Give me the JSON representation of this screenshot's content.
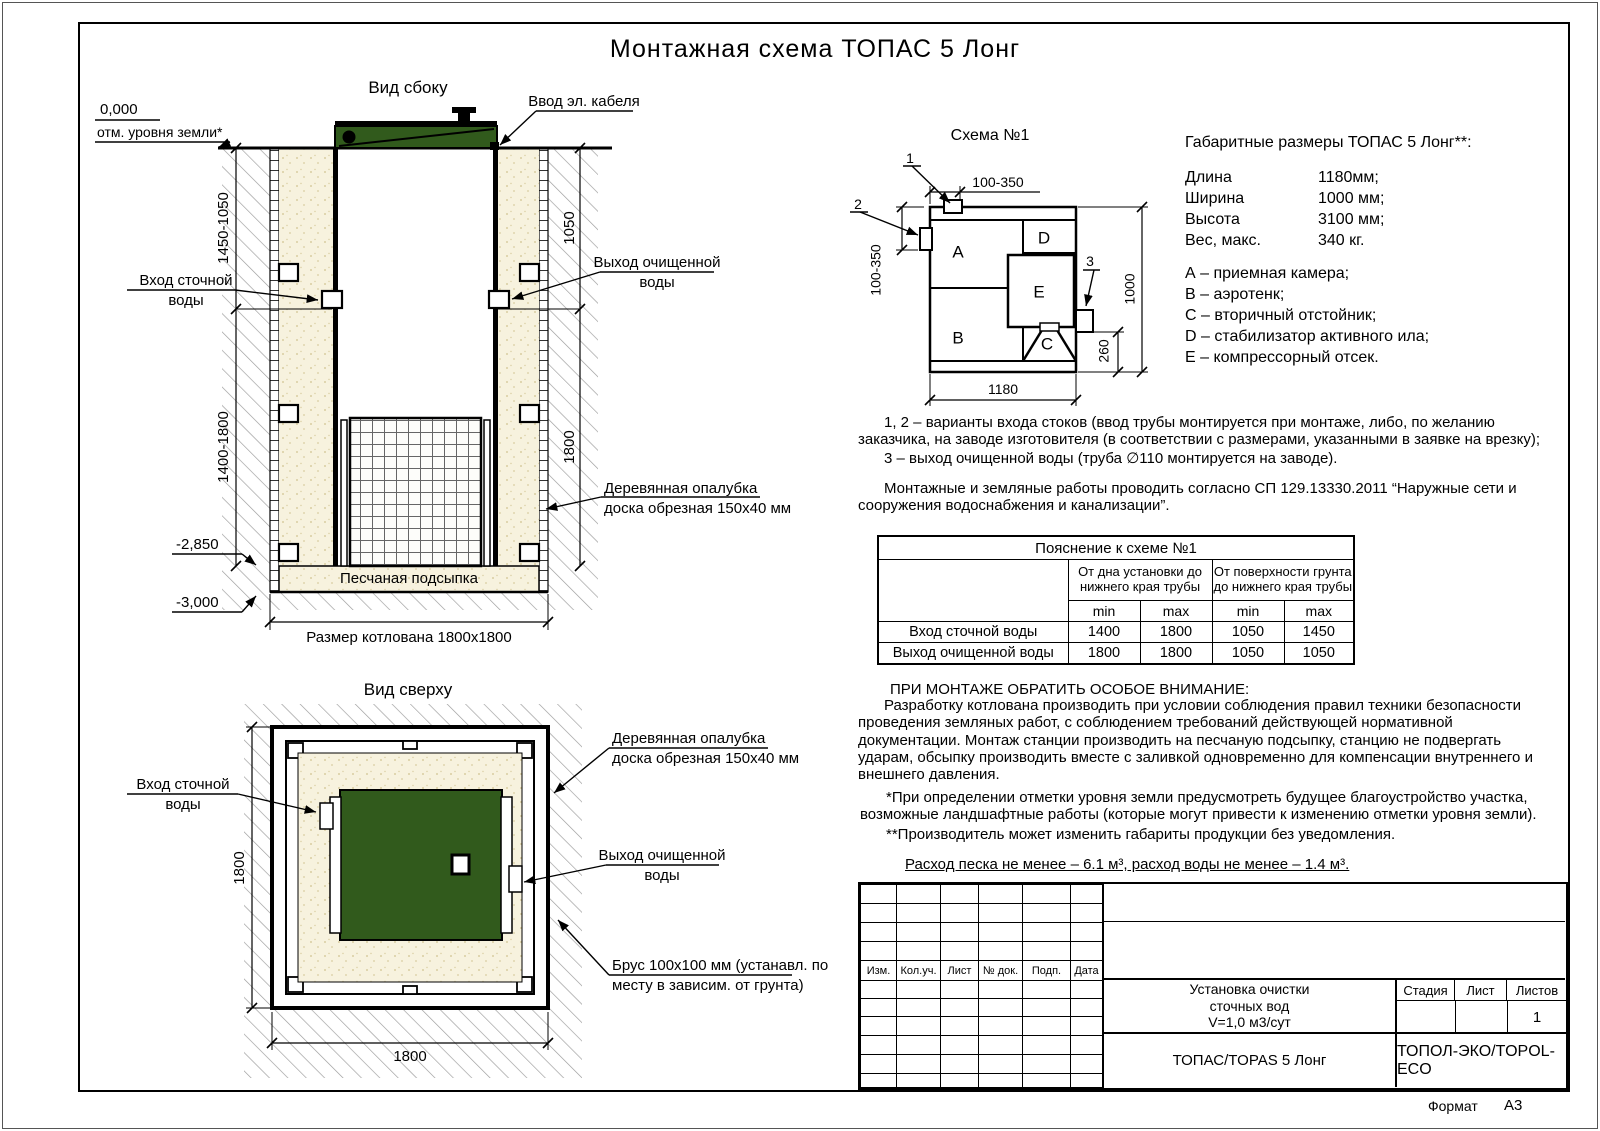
{
  "page": {
    "title": "Монтажная схема ТОПАС 5 Лонг",
    "format_label": "Формат",
    "format_value": "А3"
  },
  "side_view": {
    "title": "Вид сбоку",
    "labels": {
      "zero_level": "0,000",
      "ground_level": "отм. уровня земли*",
      "cable_entry": "Ввод эл. кабеля",
      "inlet_line1": "Вход сточной",
      "inlet_line2": "воды",
      "outlet_line1": "Выход очищенной",
      "outlet_line2": "воды",
      "formwork_line1": "Деревянная опалубка",
      "formwork_line2": "доска обрезная 150х40 мм",
      "sand_bed": "Песчаная подсыпка",
      "level_2850": "-2,850",
      "level_3000": "-3,000",
      "pit_size": "Размер котлована 1800х1800"
    },
    "dims": {
      "left_top": "1450-1050",
      "left_bottom": "1400-1800",
      "right_top": "1050",
      "right_bottom": "1800"
    }
  },
  "top_view": {
    "title": "Вид сверху",
    "labels": {
      "inlet_line1": "Вход сточной",
      "inlet_line2": "воды",
      "outlet_line1": "Выход очищенной",
      "outlet_line2": "воды",
      "formwork_line1": "Деревянная опалубка",
      "formwork_line2": "доска обрезная 150х40 мм",
      "beam_line1": "Брус 100х100 мм (устанавл. по",
      "beam_line2": "месту в зависим. от грунта)"
    },
    "dims": {
      "left": "1800",
      "bottom": "1800"
    }
  },
  "schema1": {
    "title": "Схема №1",
    "compartments": [
      "A",
      "B",
      "C",
      "D",
      "E"
    ],
    "callouts": [
      "1",
      "2",
      "3"
    ],
    "dims": {
      "top": "100-350",
      "left": "100-350",
      "right": "1000",
      "right2": "260",
      "bottom": "1180"
    }
  },
  "specs": {
    "heading": "Габаритные размеры ТОПАС 5 Лонг**:",
    "rows": [
      [
        "Длина",
        "1180мм;"
      ],
      [
        "Ширина",
        "1000 мм;"
      ],
      [
        "Высота",
        "3100 мм;"
      ],
      [
        "Вес, макс.",
        "340 кг."
      ]
    ],
    "legend": [
      "А – приемная камера;",
      "В – аэротенк;",
      "С – вторичный отстойник;",
      "D – стабилизатор активного ила;",
      "Е – компрессорный отсек."
    ]
  },
  "notes": {
    "variants": "1, 2 – варианты входа  стоков (ввод трубы монтируется при монтаже, либо, по желанию заказчика, на заводе изготовителя (в соответствии с размерами, указанными в заявке на врезку);",
    "outlet": "3 – выход очищенной воды (труба ∅110 монтируется на заводе).",
    "works": "Монтажные и земляные работы проводить согласно СП 129.13330.2011 “Наружные сети и сооружения водоснабжения и канализации”.",
    "attention_title": "ПРИ МОНТАЖЕ ОБРАТИТЬ ОСОБОЕ ВНИМАНИЕ:",
    "attention_body": "Разработку котлована производить при условии соблюдения правил техники безопасности проведения земляных работ, с соблюдением требований действующей нормативной документации. Монтаж станции производить на песчаную подсыпку, станцию не подвергать ударам, обсыпку производить вместе с заливкой одновременно для компенсации внутреннего и внешнего давления.",
    "footnote1": "*При определении отметки уровня земли предусмотреть будущее благоустройство участка, возможные ландшафтные работы (которые могут привести к изменению отметки уровня земли).",
    "footnote2": "**Производитель может изменить габариты продукции без уведомления.",
    "consumption": "Расход песка не менее – 6.1 м³, расход воды не менее – 1.4 м³."
  },
  "explain_table": {
    "title": "Пояснение к схеме №1",
    "group1": "От дна установки до нижнего края трубы",
    "group2": "От поверхности грунта до нижнего края трубы",
    "min": "min",
    "max": "max",
    "rows": [
      {
        "name": "Вход сточной воды",
        "values": [
          "1400",
          "1800",
          "1050",
          "1450"
        ]
      },
      {
        "name": "Выход очищенной воды",
        "values": [
          "1800",
          "1800",
          "1050",
          "1050"
        ]
      }
    ]
  },
  "title_block": {
    "headers": [
      "Изм.",
      "Кол.уч.",
      "Лист",
      "№ док.",
      "Подп.",
      "Дата"
    ],
    "doc_title_line1": "Установка очистки",
    "doc_title_line2": "сточных вод",
    "doc_title_line3": "V=1,0 м3/сут",
    "model": "ТОПАС/TOPAS 5 Лонг",
    "company": "ТОПОЛ-ЭКО/TOPOL-ECO",
    "stage_label": "Стадия",
    "sheet_label": "Лист",
    "sheets_label": "Листов",
    "sheets_value": "1"
  },
  "colors": {
    "tank_green": "#315a1c",
    "sand_fill": "#f7f2de",
    "hatch_gray": "#9a9a9a",
    "line": "#000000"
  }
}
